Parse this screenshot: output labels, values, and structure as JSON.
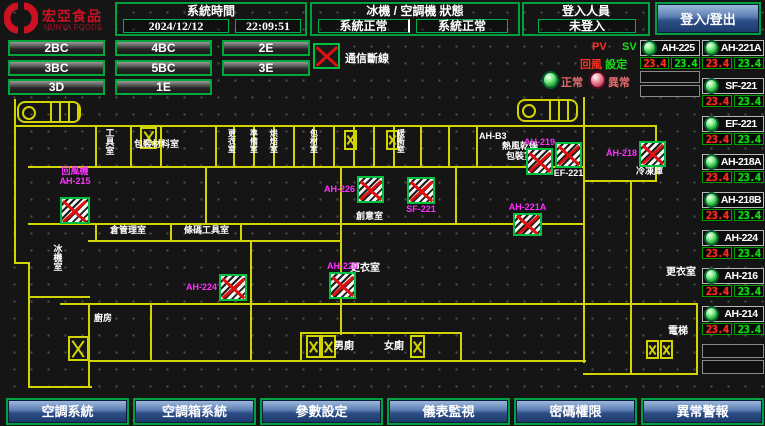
{
  "header": {
    "logo": {
      "brand": "宏亞食品",
      "brand_en": "HUNYA FOODS"
    },
    "system_time": {
      "title": "系統時間",
      "date": "2024/12/12",
      "time": "22:09:51"
    },
    "machine_status": {
      "title": "冰機 / 空調機 狀態",
      "chiller_status": "系統正常",
      "ac_status": "系統正常"
    },
    "login": {
      "title": "登入人員",
      "status": "未登入",
      "button": "登入/登出"
    }
  },
  "floor_buttons": [
    [
      "2BC",
      "4BC",
      "2E"
    ],
    [
      "3BC",
      "5BC",
      "3E"
    ],
    [
      "3D",
      "1E"
    ]
  ],
  "legend": {
    "comm_fail": "通信斷線",
    "pv": "PV",
    "sv": "SV",
    "setting_red": "回風",
    "setting_green": "設定",
    "normal": "正常",
    "abnormal": "異常"
  },
  "right_panel": {
    "col_a": {
      "unit": "AH-225",
      "pv": "23.4",
      "sv": "23.4",
      "empty_slots": 2
    },
    "units": [
      {
        "unit": "AH-221A",
        "pv": "23.4",
        "sv": "23.4"
      },
      {
        "unit": "SF-221",
        "pv": "23.4",
        "sv": "23.4"
      },
      {
        "unit": "EF-221",
        "pv": "23.4",
        "sv": "23.4"
      },
      {
        "unit": "AH-218A",
        "pv": "23.4",
        "sv": "23.4"
      },
      {
        "unit": "AH-218B",
        "pv": "23.4",
        "sv": "23.4"
      },
      {
        "unit": "AH-224",
        "pv": "23.4",
        "sv": "23.4"
      },
      {
        "unit": "AH-216",
        "pv": "23.4",
        "sv": "23.4"
      },
      {
        "unit": "AH-214",
        "pv": "23.4",
        "sv": "23.4"
      }
    ],
    "empty_slots": 2
  },
  "bottom_nav": [
    "空調系統",
    "空調箱系統",
    "參數設定",
    "儀表監視",
    "密碼權限",
    "異常警報"
  ],
  "floorplan": {
    "labels": [
      {
        "t": "冰機室",
        "x": 52,
        "y": 244,
        "v": 1
      },
      {
        "t": "工具室",
        "x": 104,
        "y": 128,
        "v": 1
      },
      {
        "t": "包裝材料室",
        "x": 134,
        "y": 140
      },
      {
        "t": "倉管理室",
        "x": 110,
        "y": 226
      },
      {
        "t": "條碼工具室",
        "x": 184,
        "y": 226
      },
      {
        "t": "更衣室",
        "x": 227,
        "y": 129,
        "v": 1,
        "fs": 8
      },
      {
        "t": "準備室",
        "x": 249,
        "y": 129,
        "v": 1,
        "fs": 8
      },
      {
        "t": "烘焙室",
        "x": 269,
        "y": 129,
        "v": 1,
        "fs": 8
      },
      {
        "t": "包材室",
        "x": 309,
        "y": 129,
        "v": 1,
        "fs": 8
      },
      {
        "t": "緩衝室",
        "x": 396,
        "y": 129,
        "v": 1,
        "fs": 8
      },
      {
        "t": "AH-B3",
        "x": 479,
        "y": 132
      },
      {
        "t": "熱風乾燥",
        "x": 502,
        "y": 142
      },
      {
        "t": "包裝室",
        "x": 506,
        "y": 152
      },
      {
        "t": "冷凍庫",
        "x": 636,
        "y": 167
      },
      {
        "t": "創意室",
        "x": 356,
        "y": 212
      },
      {
        "t": "更衣室",
        "x": 350,
        "y": 264,
        "fs": 10
      },
      {
        "t": "更衣室",
        "x": 666,
        "y": 268,
        "fs": 10
      },
      {
        "t": "廚房",
        "x": 94,
        "y": 314
      },
      {
        "t": "男廁",
        "x": 334,
        "y": 342,
        "fs": 10
      },
      {
        "t": "女廁",
        "x": 384,
        "y": 342,
        "fs": 10
      },
      {
        "t": "電梯",
        "x": 668,
        "y": 327,
        "fs": 10
      }
    ],
    "devices": [
      {
        "n": "AH-215",
        "lines": [
          "回風機",
          "AH-215"
        ],
        "x": 60,
        "y": 197,
        "w": 30,
        "h": 27,
        "lp": "above",
        "lc": "#ff30ff"
      },
      {
        "n": "AH-224",
        "lines": [
          "AH-224"
        ],
        "x": 219,
        "y": 274,
        "w": 28,
        "h": 27,
        "lp": "left",
        "lc": "#ff30ff"
      },
      {
        "n": "AH-226",
        "lines": [
          "AH-226"
        ],
        "x": 357,
        "y": 176,
        "w": 27,
        "h": 27,
        "lp": "left",
        "lc": "#ff30ff"
      },
      {
        "n": "SF-221",
        "lines": [
          "SF-221"
        ],
        "x": 407,
        "y": 177,
        "w": 28,
        "h": 27,
        "lp": "below",
        "lc": "#ff30ff"
      },
      {
        "n": "AH-220",
        "lines": [
          "AH-220"
        ],
        "x": 329,
        "y": 272,
        "w": 27,
        "h": 27,
        "lp": "above",
        "lc": "#ff30ff"
      },
      {
        "n": "AH-219",
        "lines": [
          "AH-219"
        ],
        "x": 526,
        "y": 148,
        "w": 27,
        "h": 27,
        "lp": "above",
        "lc": "#ff30ff"
      },
      {
        "n": "EF-221",
        "lines": [
          "EF-221"
        ],
        "x": 555,
        "y": 142,
        "w": 27,
        "h": 26,
        "lp": "below",
        "lc": "#ffffff"
      },
      {
        "n": "AH-218",
        "lines": [
          "AH-218"
        ],
        "x": 639,
        "y": 141,
        "w": 27,
        "h": 26,
        "lp": "left",
        "lc": "#ff30ff"
      },
      {
        "n": "AH-221A",
        "lines": [
          "AH-221A"
        ],
        "x": 513,
        "y": 213,
        "w": 29,
        "h": 23,
        "lp": "above",
        "lc": "#ff30ff"
      }
    ],
    "crossboxes": [
      [
        140,
        127,
        17,
        22
      ],
      [
        344,
        130,
        13,
        20
      ],
      [
        386,
        130,
        13,
        20
      ],
      [
        306,
        335,
        15,
        23
      ],
      [
        321,
        335,
        15,
        23
      ],
      [
        410,
        335,
        15,
        23
      ],
      [
        646,
        340,
        13,
        19
      ],
      [
        660,
        340,
        13,
        19
      ],
      [
        68,
        336,
        21,
        25
      ]
    ],
    "stairs": [
      [
        17,
        101,
        64,
        22
      ],
      [
        517,
        99,
        61,
        23
      ]
    ],
    "walls": [
      [
        14,
        125,
        641,
        2
      ],
      [
        28,
        166,
        556,
        2
      ],
      [
        14,
        99,
        2,
        165
      ],
      [
        14,
        262,
        16,
        2
      ],
      [
        28,
        262,
        2,
        126
      ],
      [
        28,
        386,
        64,
        2
      ],
      [
        88,
        303,
        2,
        85
      ],
      [
        88,
        360,
        215,
        2
      ],
      [
        300,
        332,
        2,
        30
      ],
      [
        300,
        332,
        162,
        2
      ],
      [
        460,
        332,
        2,
        30
      ],
      [
        300,
        360,
        286,
        2
      ],
      [
        583,
        97,
        2,
        266
      ],
      [
        696,
        303,
        2,
        72
      ],
      [
        583,
        373,
        115,
        2
      ],
      [
        28,
        223,
        557,
        2
      ],
      [
        88,
        240,
        254,
        2
      ],
      [
        60,
        303,
        638,
        2
      ],
      [
        95,
        125,
        2,
        43
      ],
      [
        130,
        125,
        2,
        43
      ],
      [
        160,
        125,
        2,
        43
      ],
      [
        215,
        125,
        2,
        43
      ],
      [
        233,
        125,
        2,
        43
      ],
      [
        253,
        125,
        2,
        43
      ],
      [
        273,
        125,
        2,
        43
      ],
      [
        293,
        125,
        2,
        43
      ],
      [
        313,
        125,
        2,
        43
      ],
      [
        333,
        125,
        2,
        43
      ],
      [
        353,
        125,
        2,
        43
      ],
      [
        373,
        125,
        2,
        43
      ],
      [
        393,
        125,
        2,
        43
      ],
      [
        420,
        125,
        2,
        43
      ],
      [
        448,
        125,
        2,
        43
      ],
      [
        476,
        125,
        2,
        43
      ],
      [
        205,
        166,
        2,
        59
      ],
      [
        340,
        166,
        2,
        59
      ],
      [
        340,
        225,
        2,
        110
      ],
      [
        250,
        240,
        2,
        64
      ],
      [
        455,
        166,
        2,
        59
      ],
      [
        630,
        180,
        2,
        125
      ],
      [
        630,
        303,
        2,
        70
      ],
      [
        95,
        223,
        2,
        17
      ],
      [
        170,
        223,
        2,
        17
      ],
      [
        240,
        223,
        2,
        17
      ],
      [
        150,
        303,
        2,
        57
      ],
      [
        250,
        303,
        2,
        57
      ],
      [
        655,
        125,
        2,
        57
      ],
      [
        583,
        180,
        72,
        2
      ],
      [
        28,
        296,
        62,
        2
      ]
    ]
  },
  "colors": {
    "accent_green": "#00a040",
    "wall_yellow": "#d2d400",
    "magenta": "#ff30ff",
    "pv_red": "#ff3026",
    "sv_green": "#15e015",
    "button_blue": "#2c4d86"
  }
}
